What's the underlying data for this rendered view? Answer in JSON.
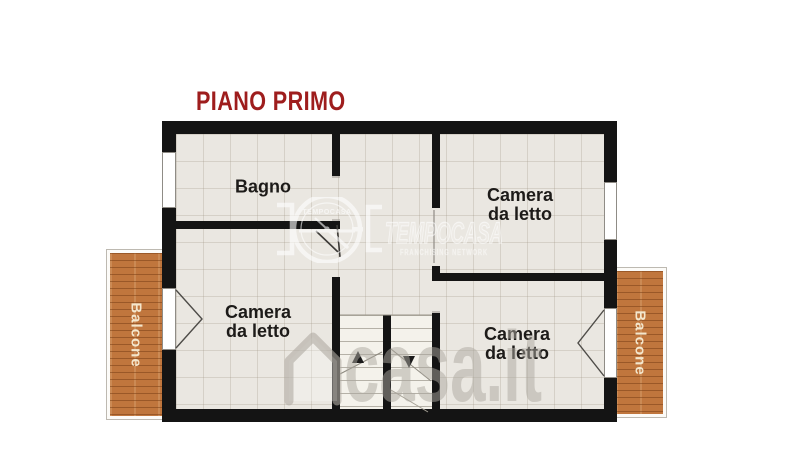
{
  "title": {
    "text": "PIANO PRIMO"
  },
  "rooms": {
    "bathroom": {
      "label": "Bagno"
    },
    "bedroom_top_right": {
      "label": "Camera da letto"
    },
    "bedroom_bottom_left": {
      "label": "Camera da letto"
    },
    "bedroom_bottom_right": {
      "label": "Camera da letto"
    }
  },
  "balconies": {
    "left": {
      "label": "Balcone"
    },
    "right": {
      "label": "Balcone"
    }
  },
  "watermarks": {
    "center": {
      "brand": "TEMPOCASA",
      "emblem_text": "TEMPOCASA",
      "subtitle": "FRANCHISING NETWORK"
    },
    "bottom": {
      "brand": "casa.it"
    }
  },
  "colors": {
    "title": "#9e1d1d",
    "wall": "#141414",
    "floor": "#eae7e1",
    "stairs": "#f4f2eb",
    "balcony": "#c0763d",
    "balcony_text": "#f4e7cd"
  }
}
